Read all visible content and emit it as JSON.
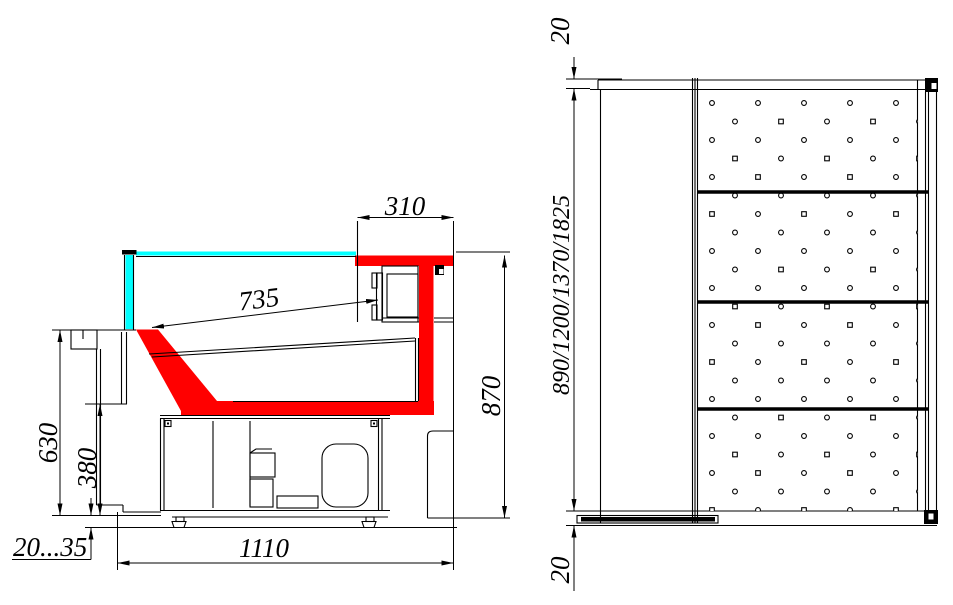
{
  "side_view": {
    "dims": {
      "canopy_depth": "310",
      "display_depth": "735",
      "front_height": "630",
      "base_height": "380",
      "overall_height": "870",
      "overall_depth": "1110",
      "leg_adjust_range": "20...35"
    }
  },
  "plan_view": {
    "dims": {
      "end_rail_top": "20",
      "case_lengths": "890/1200/1370/1825",
      "end_rail_bottom": "20"
    }
  },
  "colors": {
    "accent_red": "#ff0000",
    "glass_cyan": "#00ffff",
    "line": "#000000",
    "background": "#ffffff"
  }
}
